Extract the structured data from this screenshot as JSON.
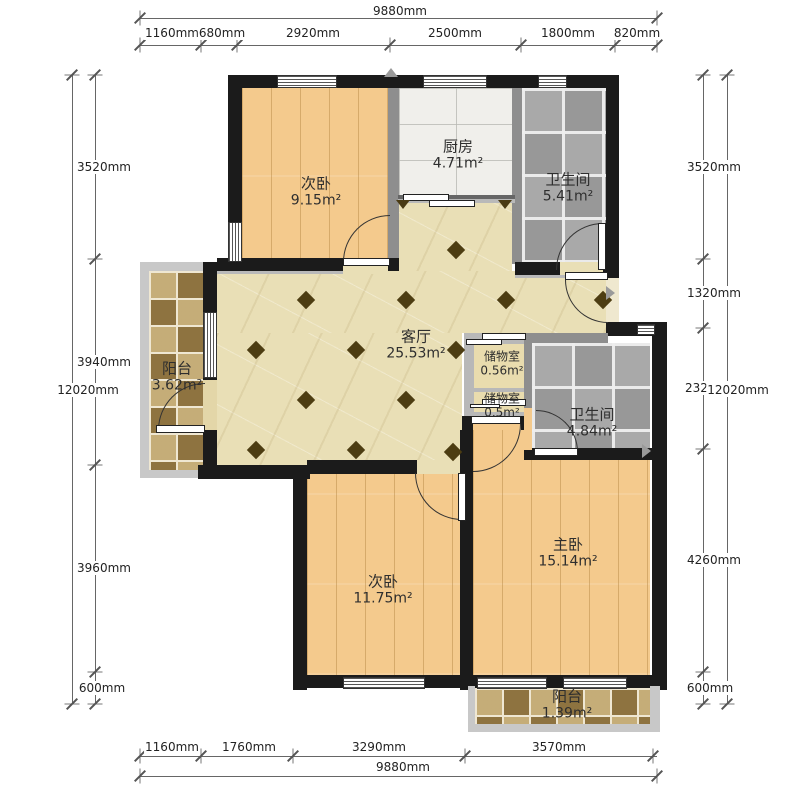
{
  "plan": {
    "dim_top_total": "9880mm",
    "dim_top_segments": [
      "1160mm",
      "680mm",
      "2920mm",
      "2500mm",
      "1800mm",
      "820mm"
    ],
    "dim_bottom_total": "9880mm",
    "dim_bottom_segments": [
      "1160mm",
      "1760mm",
      "3290mm",
      "3570mm"
    ],
    "dim_left_total": "12020mm",
    "dim_left_segments": [
      "3520mm",
      "3940mm",
      "3960mm",
      "600mm"
    ],
    "dim_right_total": "12020mm",
    "dim_right_segments": [
      "3520mm",
      "1320mm",
      "2320mm",
      "4260mm",
      "600mm"
    ]
  },
  "rooms": {
    "bedroom_top": {
      "name": "次卧",
      "area": "9.15m²"
    },
    "kitchen": {
      "name": "厨房",
      "area": "4.71m²"
    },
    "bath_top": {
      "name": "卫生间",
      "area": "5.41m²"
    },
    "living": {
      "name": "客厅",
      "area": "25.53m²"
    },
    "balcony_left": {
      "name": "阳台",
      "area": "3.62m²"
    },
    "storage_top": {
      "name": "储物室",
      "area": "0.56m²"
    },
    "storage_bottom": {
      "name": "储物室",
      "area": "0.5m²"
    },
    "bath_mid": {
      "name": "卫生间",
      "area": "4.84m²"
    },
    "bedroom_bottom": {
      "name": "次卧",
      "area": "11.75m²"
    },
    "master_bedroom": {
      "name": "主卧",
      "area": "15.14m²"
    },
    "balcony_bottom": {
      "name": "阳台",
      "area": "1.39m²"
    }
  },
  "colors": {
    "wall": "#1b1b1b",
    "partition_gray": "#8e8e8e",
    "outer_gray": "#c8c8c8",
    "wood_floor": "#f4ca8d",
    "living_floor": "#e9dfb6",
    "tile_gray": "#a4a4a4",
    "balcony_tile": "#b19457",
    "diamond_accent": "#4d3d12"
  }
}
